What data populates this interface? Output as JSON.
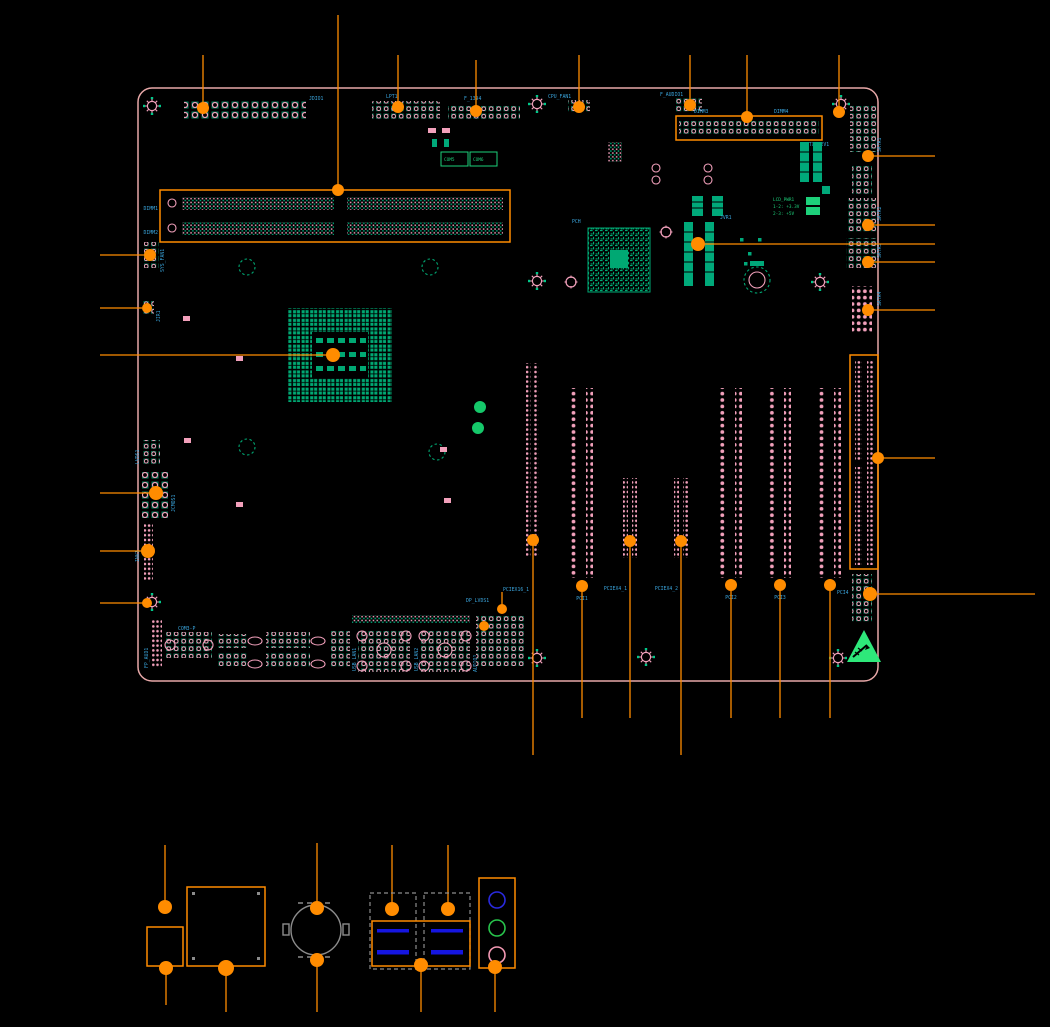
{
  "colors": {
    "background": "#000000",
    "board_outline": "#e8a8a8",
    "callout_orange": "#ff8c00",
    "silkscreen_blue": "#3aa5dd",
    "silkscreen_green": "#1dd07a",
    "component_teal": "#00a97a",
    "pad_pink": "#f2a0bb",
    "usb_tongue_blue": "#1515e0",
    "audio_line_in_blue": "#2a2ae0",
    "audio_line_out_green": "#28c44c",
    "audio_mic_pink": "#f49ab4",
    "connector_gray": "#8c8c8c",
    "esd_triangle_green": "#2ee87a"
  },
  "board": {
    "headers_top": {
      "jdio": "JDIO1",
      "lpt": "LPT1",
      "f1394": "F_1394",
      "cpu_fan": "CPU_FAN1",
      "f_audio": "F_AUDIO1"
    },
    "memory": {
      "dimm1": "DIMM1",
      "dimm2": "DIMM2",
      "dimm3": "DIMM3",
      "dimm4": "DIMM4"
    },
    "power": {
      "atx12v": "ATX_12V1"
    },
    "chipset_label": "PCH",
    "jvr_label": "JVR1",
    "jumper_table": {
      "title": "LCD_PWR1",
      "row1": "1-2: +3.3V",
      "row2": "2-3: +5V"
    },
    "com_jumpers": {
      "com5": "COM5",
      "com6": "COM6"
    },
    "left_headers": {
      "sys_fan": "SYS_FAN1",
      "jir": "JIR1",
      "lvds": "LVDS1",
      "jcmos": "JCMOS1",
      "inv": "INV1"
    },
    "right_headers": {
      "sata1": "SATA1",
      "sata2": "SATA2",
      "sata3": "SATA3",
      "sata4": "SATA4"
    },
    "slots": {
      "pciex16": "PCIEX16_1",
      "pci1": "PCI1",
      "pciex4_1": "PCIEX4_1",
      "pciex4_2": "PCIEX4_2",
      "pci2": "PCI2",
      "pci3": "PCI3",
      "pci4": "PCI4"
    },
    "bottom_headers": {
      "fp_aud": "FP_AUD1",
      "com3": "COM3-P",
      "dp_lvds": "DP_LVDS1",
      "usb_lan1": "USB_LAN1",
      "usb_lan2": "USB_LAN2",
      "audio": "AUDIO1"
    }
  }
}
